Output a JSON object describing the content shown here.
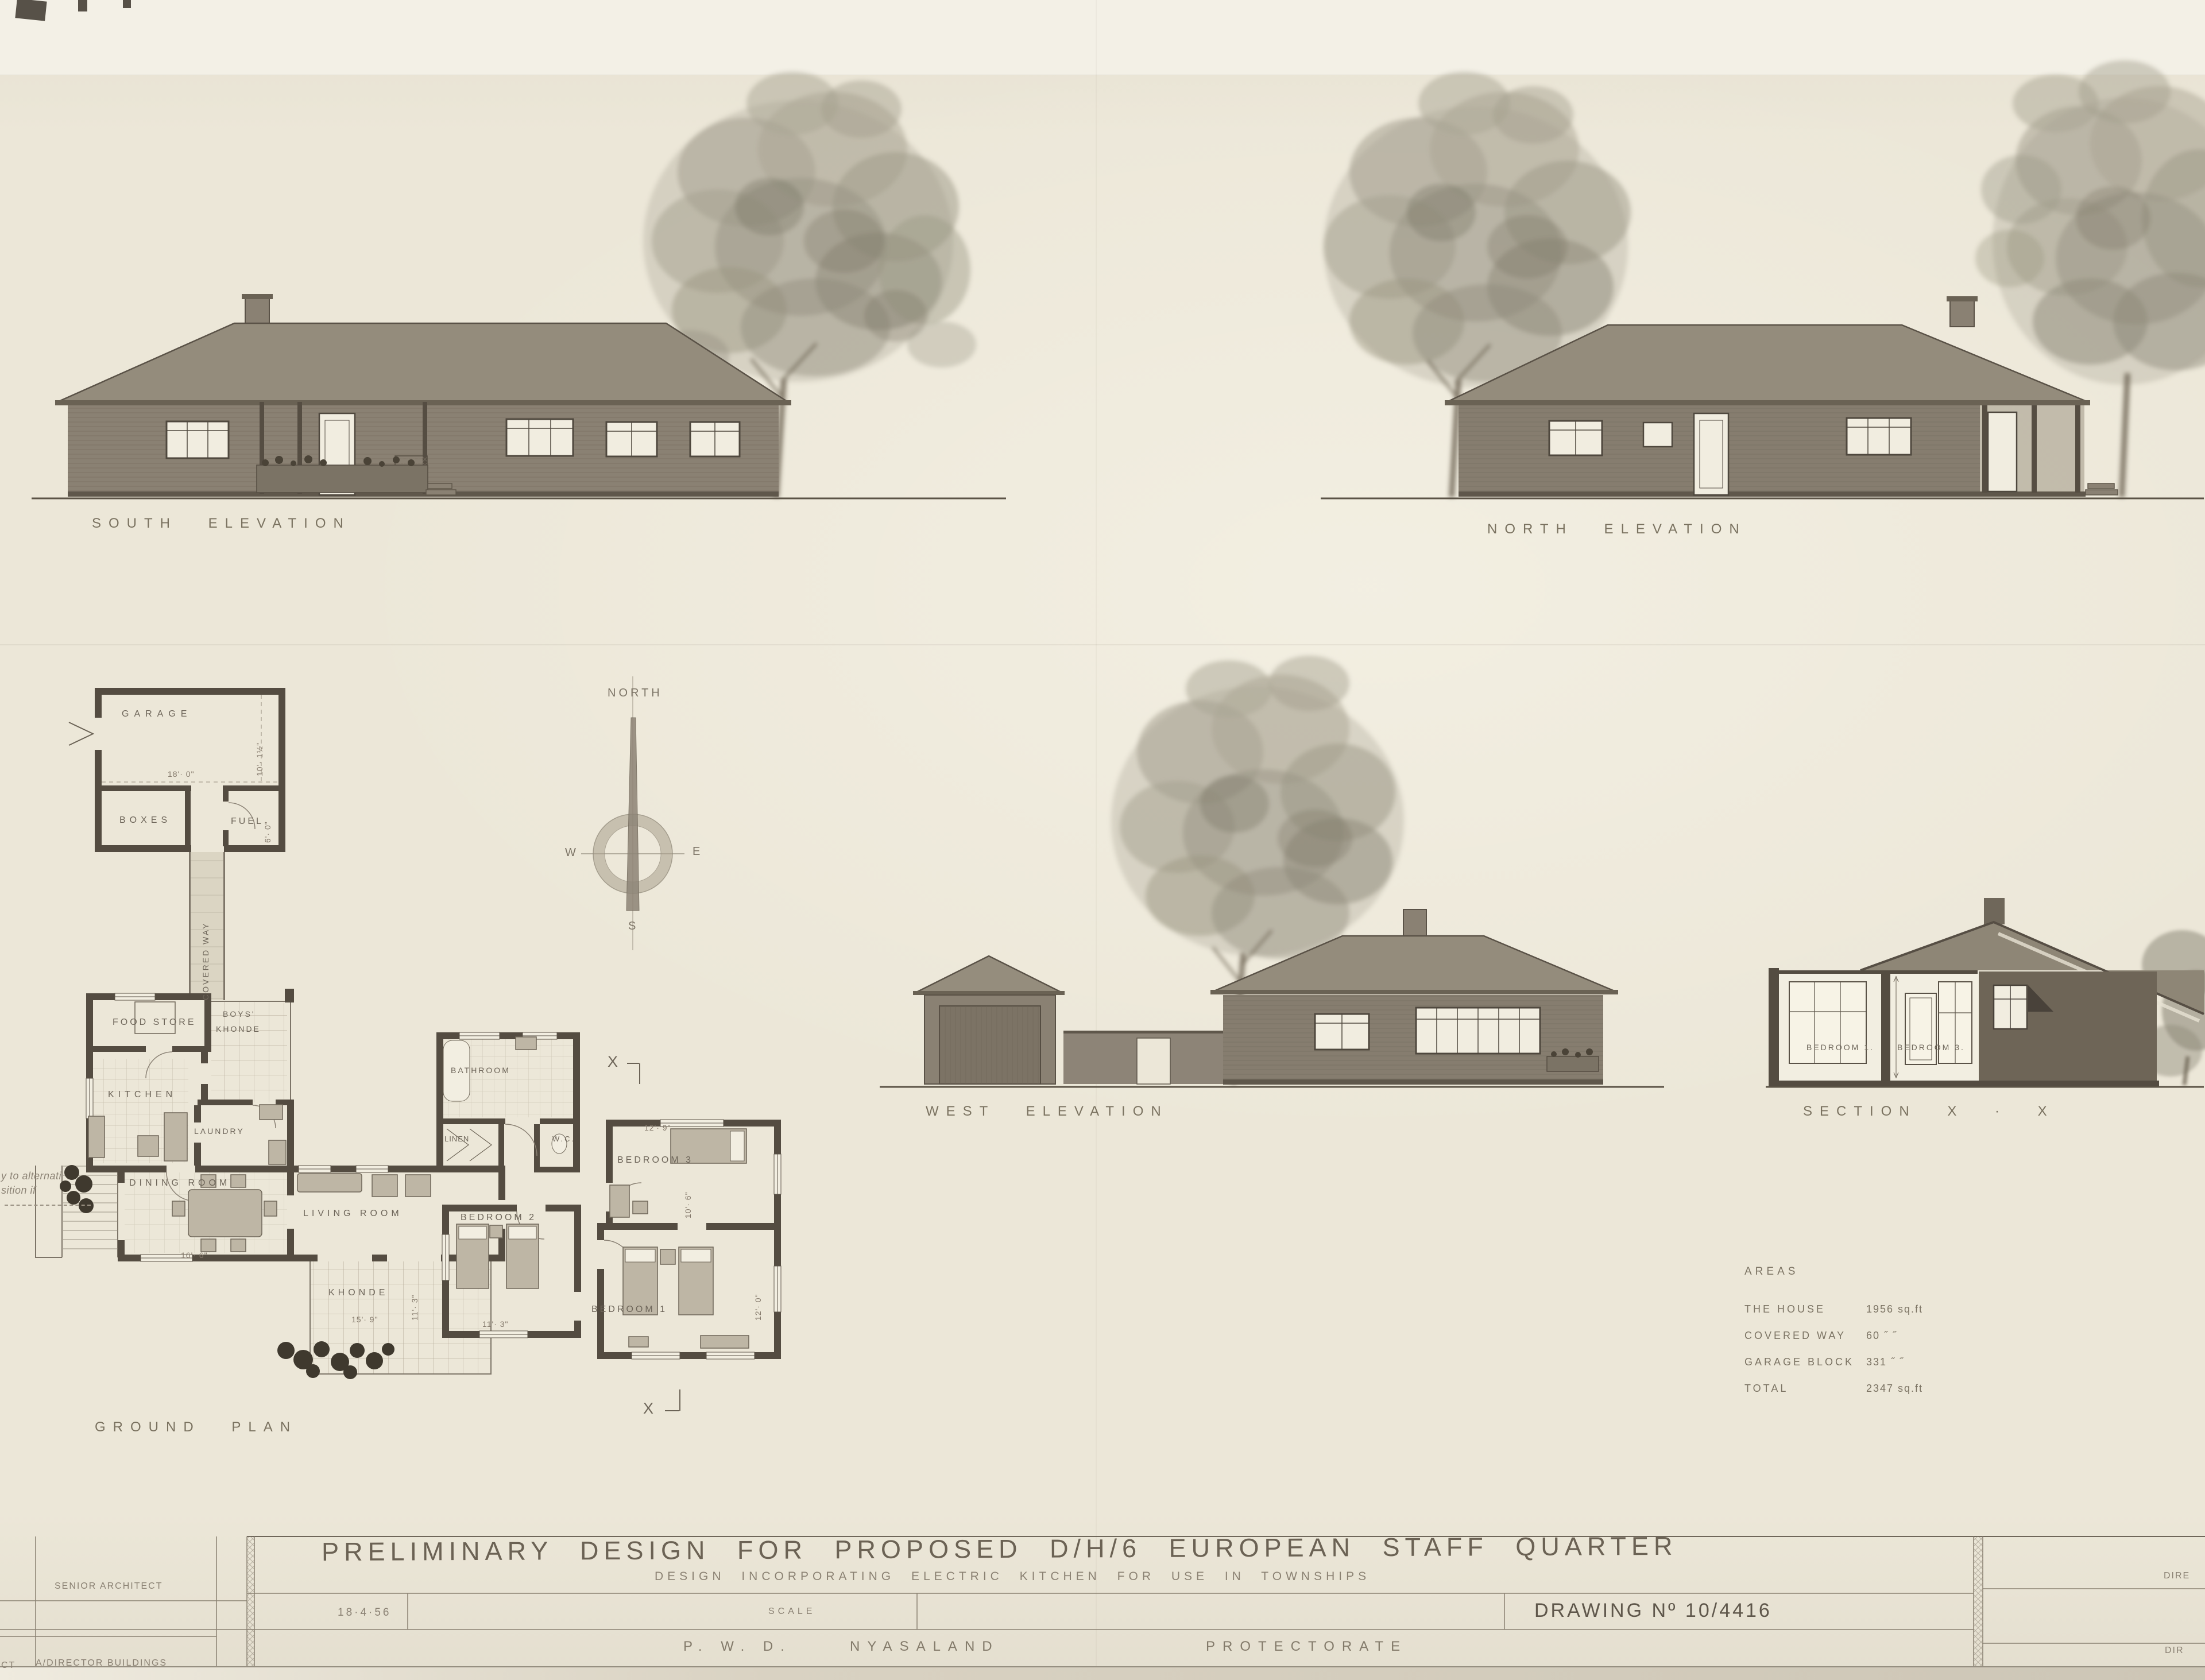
{
  "drawing_labels": {
    "south_elevation": "SOUTH ELEVATION",
    "north_elevation": "NORTH ELEVATION",
    "west_elevation": "WEST ELEVATION",
    "section_xx": "SECTION X · X",
    "ground_plan": "GROUND PLAN",
    "section_marker": "X"
  },
  "compass": {
    "north_label": "NORTH",
    "west": "W",
    "east": "E",
    "south": "S"
  },
  "margin_note": {
    "line1": "y to alternati",
    "line2": "sition if"
  },
  "plan": {
    "rooms": {
      "garage": "GARAGE",
      "boxes": "BOXES",
      "fuel": "FUEL",
      "covered_way": "COVERED WAY",
      "food_store": "FOOD STORE",
      "boys_khonde_1": "BOYS'",
      "boys_khonde_2": "KHONDE",
      "kitchen": "KITCHEN",
      "laundry": "LAUNDRY",
      "dining_room": "DINING ROOM",
      "living_room": "LIVING ROOM",
      "khonde": "KHONDE",
      "bathroom": "BATHROOM",
      "linen": "LINEN",
      "wc": "W.C.",
      "bedroom3": "BEDROOM 3",
      "bedroom2": "BEDROOM 2",
      "bedroom1": "BEDROOM 1"
    },
    "dims": {
      "garage_w": "18'· 0\"",
      "garage_d": "10'· 1½\"",
      "fuel_d": "6'· 0\"",
      "dining_w": "16'· 6\"",
      "khonde_w": "15'· 9\"",
      "khonde_d": "11'· 3\"",
      "bed3_w": "12'· 9\"",
      "bed3_d": "10'· 6\"",
      "bed2_w": "11'· 3\"",
      "bed1_d": "12'· 0\""
    }
  },
  "section": {
    "bedroom1": "BEDROOM 1.",
    "bedroom3": "BEDROOM 3."
  },
  "areas": {
    "title": "AREAS",
    "rows": [
      {
        "item": "THE HOUSE",
        "value": "1956 sq.ft"
      },
      {
        "item": "COVERED WAY",
        "value": "60 ˝ ˝"
      },
      {
        "item": "GARAGE BLOCK",
        "value": "331 ˝ ˝"
      },
      {
        "item": "TOTAL",
        "value": "2347 sq.ft"
      }
    ]
  },
  "title_block": {
    "title": "PRELIMINARY DESIGN FOR PROPOSED D/H/6 EUROPEAN STAFF QUARTER",
    "subtitle": "DESIGN INCORPORATING ELECTRIC KITCHEN FOR USE IN TOWNSHIPS",
    "date": "18·4·56",
    "scale_label": "SCALE",
    "drawing_no": "DRAWING Nº 10/4416",
    "org_pwd": "P. W. D.",
    "org_territory": "NYASALAND",
    "org_protectorate": "PROTECTORATE",
    "senior_architect": "SENIOR ARCHITECT",
    "director_buildings": "A/DIRECTOR BUILDINGS",
    "partial_left": "CT",
    "partial_right_top": "DIRE",
    "partial_right_bottom": "DIR"
  }
}
